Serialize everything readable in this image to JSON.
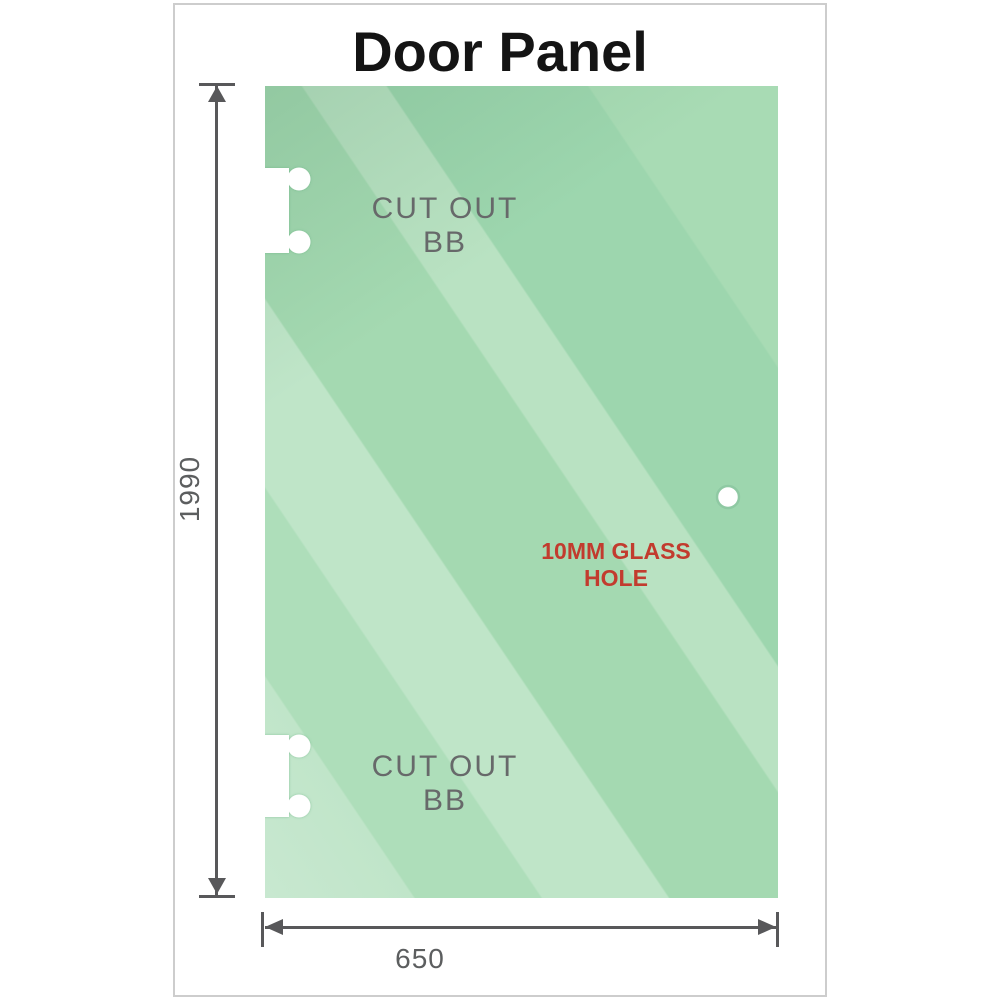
{
  "title": "Door Panel",
  "labels": {
    "cut_out_top": "CUT OUT BB",
    "cut_out_bottom": "CUT OUT BB",
    "glass_hole": "10MM GLASS HOLE"
  },
  "dims": {
    "height": "1990",
    "width": "650"
  },
  "colors": {
    "glass_base": "#a4d9b1",
    "glass_light": "#c8e8d0",
    "glass_dark": "#8ccda2",
    "dimension_gray": "#58585a",
    "label_gray": "#67696a",
    "hole_label_red": "#c23b2e",
    "frame_border": "#cdcdcd",
    "title_color": "#141414"
  }
}
